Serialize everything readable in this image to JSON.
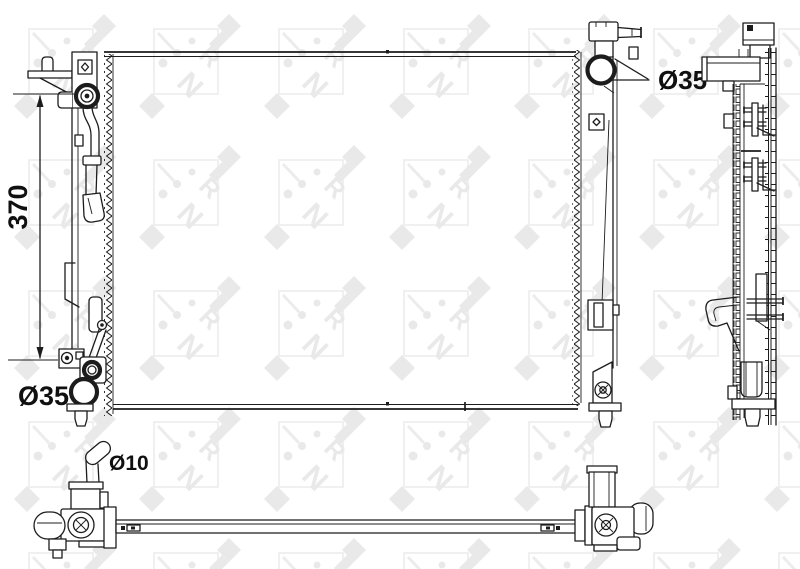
{
  "watermark": {
    "brand": "NRF",
    "letter_n": "N",
    "letter_r": "R",
    "color": "#e9e9e9"
  },
  "labels": {
    "core_height": "370",
    "outlet_diameter": "Ø35",
    "filler_neck_diameter": "Ø35",
    "overflow_pipe_diameter": "Ø10"
  },
  "colors": {
    "line": "#1c1c1c",
    "background": "#ffffff",
    "watermark": "#e9e9e9"
  }
}
